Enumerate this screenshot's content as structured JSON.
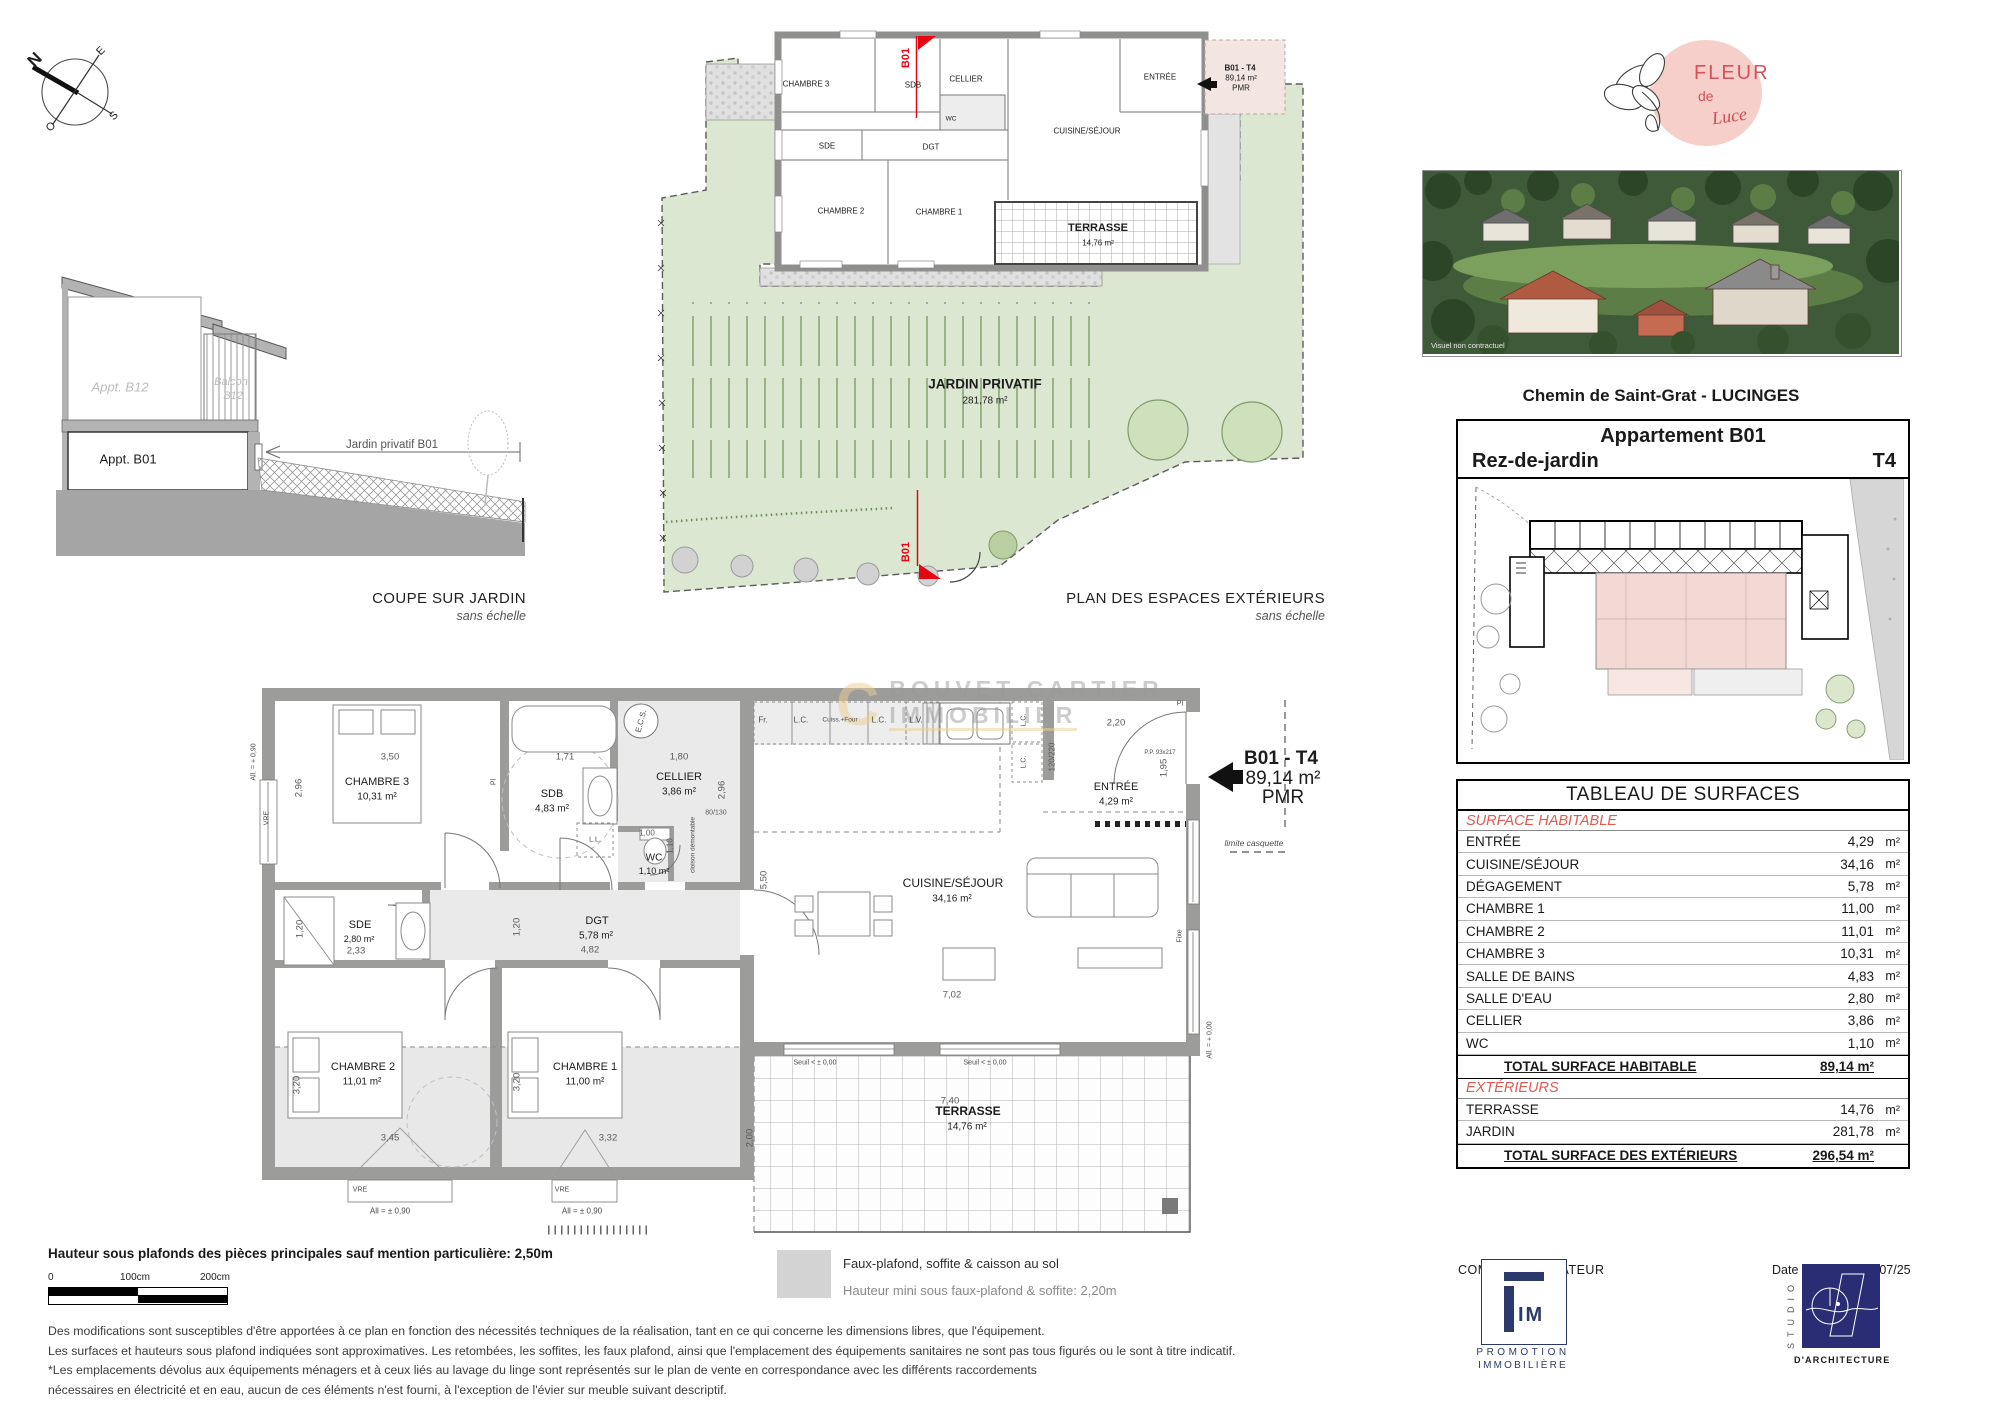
{
  "colors": {
    "red": "#e30613",
    "table_red": "#e05a50",
    "wall": "#9c9c9b",
    "garden": "#dce7d1",
    "pink": "#f3e5e1",
    "navy_fim": "#2c3a6b",
    "navy_studio": "#2a2d74",
    "logo_pink": "#f7cfca",
    "logo_red": "#d5525b",
    "watermark_gold": "#eccf92"
  },
  "compass": {
    "letters": [
      {
        "t": "N",
        "x": 35,
        "y": 60,
        "size": 17,
        "bold": true,
        "rot": -45
      },
      {
        "t": "E",
        "x": 101,
        "y": 51,
        "size": 11,
        "rot": -45
      },
      {
        "t": "S",
        "x": 114,
        "y": 116,
        "size": 11,
        "rot": -45
      },
      {
        "t": "O",
        "x": 51,
        "y": 127,
        "size": 11,
        "rot": -45
      }
    ]
  },
  "coupe": {
    "title": "COUPE SUR JARDIN",
    "subtitle": "sans échelle",
    "labels": [
      {
        "t": "Appt. B12",
        "x": 120,
        "y": 387,
        "size": 13,
        "cls": "ghost"
      },
      {
        "t": "Balcon",
        "x": 231,
        "y": 382,
        "size": 11,
        "cls": "ghost"
      },
      {
        "t": "B12",
        "x": 233,
        "y": 396,
        "size": 11,
        "cls": "ghost"
      },
      {
        "t": "Appt. B01",
        "x": 128,
        "y": 459,
        "size": 13
      },
      {
        "t": "Jardin privatif B01",
        "x": 392,
        "y": 445,
        "size": 11.5,
        "color": "#555555"
      }
    ]
  },
  "ext_plan": {
    "title": "PLAN DES ESPACES EXTÉRIEURS",
    "subtitle": "sans échelle",
    "labels": [
      {
        "t": "CHAMBRE 3",
        "x": 806,
        "y": 84
      },
      {
        "t": "SDB",
        "x": 913,
        "y": 85
      },
      {
        "t": "CELLIER",
        "x": 966,
        "y": 79
      },
      {
        "t": "WC",
        "x": 951,
        "y": 119,
        "size": 6.5
      },
      {
        "t": "SDE",
        "x": 827,
        "y": 146
      },
      {
        "t": "DGT",
        "x": 931,
        "y": 147
      },
      {
        "t": "CHAMBRE 2",
        "x": 841,
        "y": 211
      },
      {
        "t": "CHAMBRE 1",
        "x": 939,
        "y": 212
      },
      {
        "t": "ENTRÉE",
        "x": 1160,
        "y": 77
      },
      {
        "t": "CUISINE/SÉJOUR",
        "x": 1087,
        "y": 131
      },
      {
        "t": "TERRASSE",
        "x": 1098,
        "y": 228,
        "size": 11,
        "bold": true
      },
      {
        "t": "14,76 m²",
        "x": 1098,
        "y": 243,
        "size": 8
      },
      {
        "t": "JARDIN PRIVATIF",
        "x": 985,
        "y": 384,
        "size": 13.5,
        "bold": true
      },
      {
        "t": "281,78 m²",
        "x": 985,
        "y": 401,
        "size": 10
      },
      {
        "t": "B01",
        "x": 906,
        "y": 58,
        "size": 11,
        "rot": -90,
        "cls": "redlbl"
      },
      {
        "t": "B01",
        "x": 906,
        "y": 552,
        "size": 11,
        "rot": -90,
        "cls": "redlbl"
      },
      {
        "t": "B01 - T4",
        "x": 1240,
        "y": 68,
        "size": 8,
        "bold": true
      },
      {
        "t": "89,14 m²",
        "x": 1241,
        "y": 78,
        "size": 8
      },
      {
        "t": "PMR",
        "x": 1241,
        "y": 88,
        "size": 8
      }
    ]
  },
  "main_plan": {
    "rooms": [
      {
        "t": "CHAMBRE 3",
        "x": 377,
        "y": 782
      },
      {
        "t": "10,31 m²",
        "x": 377,
        "y": 797,
        "size": 10
      },
      {
        "t": "SDB",
        "x": 552,
        "y": 794
      },
      {
        "t": "4,83 m²",
        "x": 552,
        "y": 809,
        "size": 10
      },
      {
        "t": "CELLIER",
        "x": 679,
        "y": 777
      },
      {
        "t": "3,86 m²",
        "x": 679,
        "y": 792,
        "size": 10
      },
      {
        "t": "WC",
        "x": 654,
        "y": 858,
        "size": 10
      },
      {
        "t": "1,10 m²",
        "x": 654,
        "y": 871,
        "size": 9
      },
      {
        "t": "SDE",
        "x": 360,
        "y": 925
      },
      {
        "t": "2,80 m²",
        "x": 359,
        "y": 939,
        "size": 9
      },
      {
        "t": "DGT",
        "x": 597,
        "y": 921
      },
      {
        "t": "5,78 m²",
        "x": 596,
        "y": 936,
        "size": 10
      },
      {
        "t": "CHAMBRE 2",
        "x": 363,
        "y": 1067
      },
      {
        "t": "11,01 m²",
        "x": 362,
        "y": 1082,
        "size": 10
      },
      {
        "t": "CHAMBRE 1",
        "x": 585,
        "y": 1067
      },
      {
        "t": "11,00 m²",
        "x": 585,
        "y": 1082,
        "size": 10
      },
      {
        "t": "CUISINE/SÉJOUR",
        "x": 953,
        "y": 883,
        "size": 12
      },
      {
        "t": "34,16 m²",
        "x": 952,
        "y": 899,
        "size": 10
      },
      {
        "t": "ENTRÉE",
        "x": 1116,
        "y": 787
      },
      {
        "t": "4,29 m²",
        "x": 1116,
        "y": 802,
        "size": 10
      },
      {
        "t": "TERRASSE",
        "x": 968,
        "y": 1111,
        "bold": true,
        "size": 12
      },
      {
        "t": "14,76 m²",
        "x": 967,
        "y": 1127,
        "size": 10
      }
    ],
    "unit_label": [
      {
        "t": "B01 - T4",
        "x": 1281,
        "y": 759,
        "size": 19,
        "bold": true
      },
      {
        "t": "89,14 m²",
        "x": 1283,
        "y": 779,
        "size": 19
      },
      {
        "t": "PMR",
        "x": 1283,
        "y": 798,
        "size": 19
      }
    ],
    "dims": [
      {
        "t": "3,50",
        "x": 390,
        "y": 757
      },
      {
        "t": "2,96",
        "x": 299,
        "y": 788,
        "rot": -90
      },
      {
        "t": "1,71",
        "x": 565,
        "y": 757
      },
      {
        "t": "1,80",
        "x": 679,
        "y": 757
      },
      {
        "t": "2,96",
        "x": 722,
        "y": 790,
        "rot": -90
      },
      {
        "t": "80/130",
        "x": 716,
        "y": 813,
        "size": 7
      },
      {
        "t": "1,00",
        "x": 647,
        "y": 833,
        "size": 8
      },
      {
        "t": "1,10",
        "x": 670,
        "y": 846,
        "rot": -90,
        "size": 8
      },
      {
        "t": "2,33",
        "x": 356,
        "y": 951
      },
      {
        "t": "1,20",
        "x": 300,
        "y": 929,
        "rot": -90
      },
      {
        "t": "1,20",
        "x": 517,
        "y": 927,
        "rot": -90
      },
      {
        "t": "4,82",
        "x": 590,
        "y": 950
      },
      {
        "t": "3,45",
        "x": 390,
        "y": 1138
      },
      {
        "t": "3,20",
        "x": 297,
        "y": 1085,
        "rot": -90
      },
      {
        "t": "3,32",
        "x": 608,
        "y": 1138
      },
      {
        "t": "3,20",
        "x": 517,
        "y": 1082,
        "rot": -90
      },
      {
        "t": "5,50",
        "x": 764,
        "y": 880,
        "rot": -90
      },
      {
        "t": "7,02",
        "x": 952,
        "y": 995
      },
      {
        "t": "7,40",
        "x": 950,
        "y": 1101
      },
      {
        "t": "2,00",
        "x": 750,
        "y": 1138,
        "rot": -90
      },
      {
        "t": "2,20",
        "x": 1116,
        "y": 723
      },
      {
        "t": "120/220",
        "x": 1052,
        "y": 757,
        "rot": -90,
        "size": 8
      },
      {
        "t": "1,95",
        "x": 1164,
        "y": 768,
        "rot": -90
      }
    ],
    "annotations": [
      {
        "t": "VRE",
        "x": 267,
        "y": 818,
        "rot": -90,
        "size": 7
      },
      {
        "t": "VRE",
        "x": 360,
        "y": 1190,
        "size": 7
      },
      {
        "t": "VRE",
        "x": 562,
        "y": 1190,
        "size": 7
      },
      {
        "t": "All = ± 0,90",
        "x": 390,
        "y": 1211,
        "size": 8
      },
      {
        "t": "All = ± 0,90",
        "x": 582,
        "y": 1211,
        "size": 8
      },
      {
        "t": "All. = + 0,90",
        "x": 254,
        "y": 762,
        "rot": -90,
        "size": 7
      },
      {
        "t": "Seuil < ± 0,00",
        "x": 815,
        "y": 1063,
        "size": 7
      },
      {
        "t": "Seuil < ± 0,00",
        "x": 985,
        "y": 1063,
        "size": 7
      },
      {
        "t": "All. = + 0,00",
        "x": 1210,
        "y": 1040,
        "rot": -90,
        "size": 7
      },
      {
        "t": "Fixe",
        "x": 1180,
        "y": 936,
        "rot": -90,
        "size": 7
      },
      {
        "t": "limite casquette",
        "x": 1254,
        "y": 843,
        "size": 8.5,
        "italic": true
      },
      {
        "t": "cloison démontable",
        "x": 693,
        "y": 845,
        "rot": -90,
        "size": 6.5
      },
      {
        "t": "P.P. 93x217",
        "x": 1160,
        "y": 753,
        "size": 6
      },
      {
        "t": "Pl",
        "x": 494,
        "y": 782,
        "rot": -90,
        "size": 7
      },
      {
        "t": "E.C.S.",
        "x": 641,
        "y": 721,
        "rot": -75,
        "size": 8
      },
      {
        "t": "L.L.",
        "x": 595,
        "y": 840,
        "size": 7
      },
      {
        "t": "Fr.",
        "x": 763,
        "y": 720,
        "size": 8
      },
      {
        "t": "L.C.",
        "x": 801,
        "y": 720,
        "size": 8
      },
      {
        "t": "Cuiss.+Four",
        "x": 840,
        "y": 720,
        "size": 6.5
      },
      {
        "t": "L.C.",
        "x": 879,
        "y": 720,
        "size": 8
      },
      {
        "t": "L.V.",
        "x": 916,
        "y": 720,
        "size": 8
      },
      {
        "t": "L.C.",
        "x": 1024,
        "y": 720,
        "rot": -90,
        "size": 7
      },
      {
        "t": "L.C.",
        "x": 1024,
        "y": 762,
        "rot": -90,
        "size": 7
      },
      {
        "t": "PI",
        "x": 1180,
        "y": 704,
        "size": 7
      }
    ],
    "watermark": {
      "logo": "C",
      "line1": "BOUVET CARTIER",
      "line2": "IMMOBILIER"
    }
  },
  "right_col": {
    "logo": {
      "l1": "FLEUR",
      "l2": "de",
      "l3": "Luce"
    },
    "photo_watermark": "Visuel non contractuel",
    "photo_caption": "Chemin de Saint-Grat - LUCINGES",
    "unit_box": {
      "title": "Appartement B01",
      "floor": "Rez-de-jardin",
      "type": "T4"
    },
    "table": {
      "title": "TABLEAU DE SURFACES",
      "rows": [
        {
          "cls": "sec",
          "label": "SURFACE HABITABLE"
        },
        {
          "cls": "r",
          "label": "ENTRÉE",
          "value": "4,29",
          "unit": "m²"
        },
        {
          "cls": "r",
          "label": "CUISINE/SÉJOUR",
          "value": "34,16",
          "unit": "m²"
        },
        {
          "cls": "r",
          "label": "DÉGAGEMENT",
          "value": "5,78",
          "unit": "m²"
        },
        {
          "cls": "r",
          "label": "CHAMBRE 1",
          "value": "11,00",
          "unit": "m²"
        },
        {
          "cls": "r",
          "label": "CHAMBRE 2",
          "value": "11,01",
          "unit": "m²"
        },
        {
          "cls": "r",
          "label": "CHAMBRE 3",
          "value": "10,31",
          "unit": "m²"
        },
        {
          "cls": "r",
          "label": "SALLE DE BAINS",
          "value": "4,83",
          "unit": "m²"
        },
        {
          "cls": "r",
          "label": "SALLE D'EAU",
          "value": "2,80",
          "unit": "m²"
        },
        {
          "cls": "r",
          "label": "CELLIER",
          "value": "3,86",
          "unit": "m²"
        },
        {
          "cls": "r",
          "label": "WC",
          "value": "1,10",
          "unit": "m²"
        },
        {
          "cls": "tot",
          "label": "TOTAL SURFACE HABITABLE",
          "value": "89,14 m²"
        },
        {
          "cls": "sec",
          "label": "EXTÉRIEURS"
        },
        {
          "cls": "r",
          "label": "TERRASSE",
          "value": "14,76",
          "unit": "m²"
        },
        {
          "cls": "r",
          "label": "JARDIN",
          "value": "281,78",
          "unit": "m²"
        },
        {
          "cls": "tot",
          "label": "TOTAL SURFACE DES EXTÉRIEURS",
          "value": "296,54 m²"
        }
      ]
    }
  },
  "footer": {
    "height_note": "Hauteur sous plafonds des pièces principales sauf mention particulière: 2,50m",
    "scale": {
      "t0": "0",
      "t1": "100cm",
      "t2": "200cm"
    },
    "legend_line1": "Faux-plafond, soffite & caisson au sol",
    "legend_line2": "Hauteur mini sous faux-plafond & soffite: 2,20m",
    "disclaimer": [
      "Des modifications sont susceptibles d'être apportées à ce plan en fonction des nécessités techniques de la réalisation, tant en ce qui concerne les dimensions libres, que l'équipement.",
      "Les surfaces et hauteurs sous plafond indiquées sont approximatives. Les retombées, les soffites, les faux plafond, ainsi que l'emplacement des équipements sanitaires ne sont pas tous figurés ou le sont à titre indicatif.",
      "*Les emplacements dévolus aux équipements ménagers et à ceux liés au lavage du linge sont représentés sur le plan de vente en correspondance avec les différents raccordements",
      "nécessaires en électricité et en eau, aucun de ces éléments n'est fourni, à l'exception de l'évier sur meuble suivant descriptif."
    ],
    "commercialisateur": "COMMERCIALISATEUR",
    "date_label": "Date d'édition :",
    "date_value": "10/07/25",
    "fim": {
      "im": "IM",
      "line1": "PROMOTION",
      "line2": "IMMOBILIÈRE"
    },
    "studio": {
      "vertical": "STUDIO",
      "caption": "D'ARCHITECTURE"
    }
  }
}
